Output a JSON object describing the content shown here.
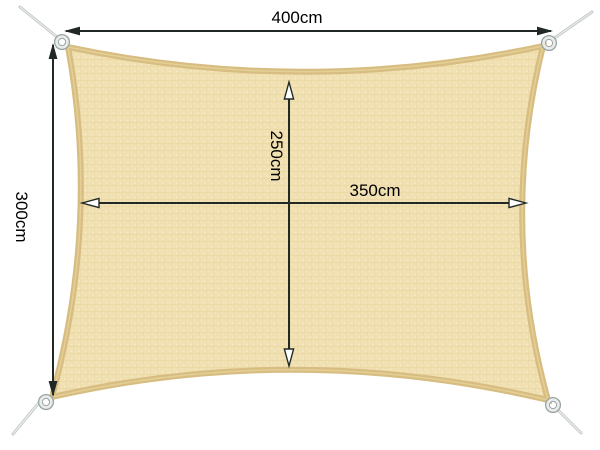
{
  "diagram": {
    "title": "Rectangular shade sail dimension diagram",
    "background_color": "#ffffff"
  },
  "sail": {
    "shape": "rectangle with concave edges",
    "fabric_color": "#f1e1b2",
    "fabric_weave_color": "#e5d29d",
    "hem_color": "#d8bd82",
    "ring_color": "#9aa4a3",
    "rope_color": "#c6cacb",
    "corner_count": "4"
  },
  "lines": {
    "color": "#212925"
  },
  "dimensions": {
    "outer_width": {
      "label": "400cm",
      "position": "top",
      "arrow_style": "solid"
    },
    "outer_height": {
      "label": "300cm",
      "position": "left",
      "arrow_style": "solid"
    },
    "inner_width": {
      "label": "350cm",
      "position": "center-horizontal",
      "arrow_style": "hollow"
    },
    "inner_height": {
      "label": "250cm",
      "position": "center-vertical",
      "arrow_style": "hollow"
    }
  }
}
